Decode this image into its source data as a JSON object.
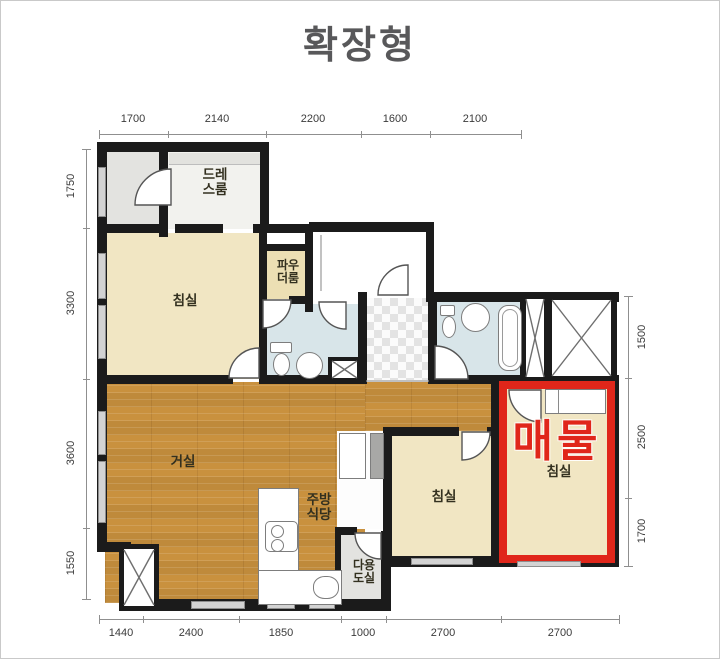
{
  "title": "확장형",
  "highlight": {
    "label": "매물",
    "color": "#e0261a"
  },
  "rooms": {
    "dress": {
      "line1": "드레",
      "line2": "스룸"
    },
    "powder": {
      "line1": "파우",
      "line2": "더룸"
    },
    "bedroom1": {
      "label": "침실"
    },
    "living": {
      "label": "거실"
    },
    "kitchen": {
      "line1": "주방",
      "line2": "식당"
    },
    "utility": {
      "line1": "다용",
      "line2": "도실"
    },
    "bedroom2": {
      "label": "침실"
    },
    "bedroom3": {
      "label": "침실"
    }
  },
  "dimensions": {
    "top": [
      "1700",
      "2140",
      "2200",
      "1600",
      "2100"
    ],
    "left": [
      "1750",
      "3300",
      "3600",
      "1550"
    ],
    "right": [
      "1500",
      "2500",
      "1700"
    ],
    "bottom": [
      "1440",
      "2400",
      "1850",
      "1000",
      "2700",
      "2700"
    ]
  },
  "colors": {
    "wall": "#1b1b1b",
    "bedroom_floor": "#f1e6c3",
    "wood_floor": "#c9913e",
    "bath_floor": "#d8e5e9",
    "entry_floor": "#e3e3e0",
    "highlight_red": "#e0261a"
  }
}
